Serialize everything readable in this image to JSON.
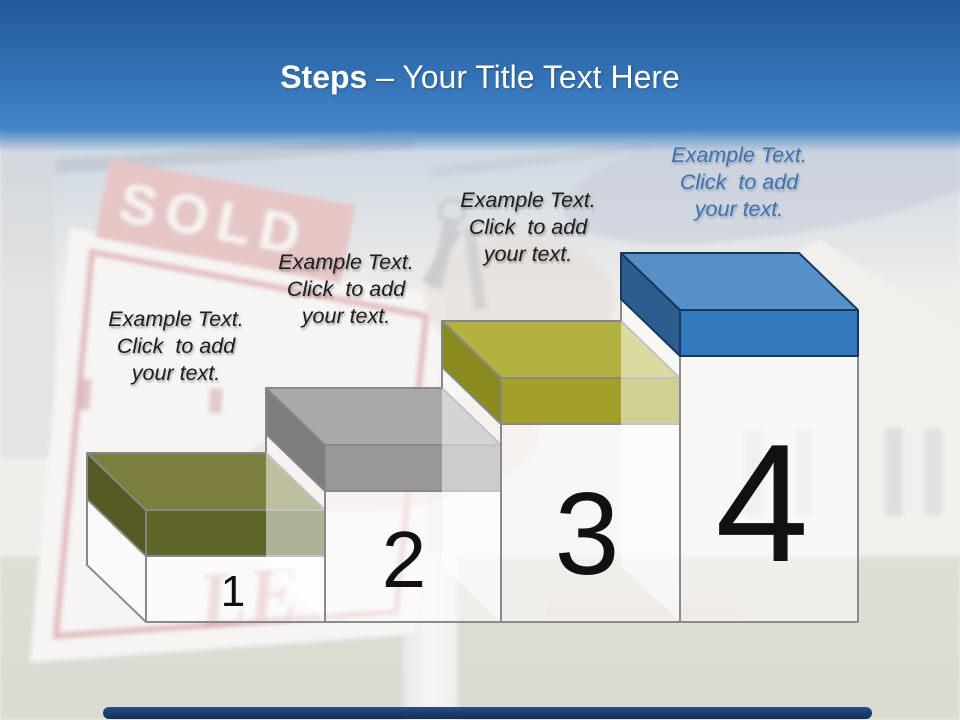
{
  "title": {
    "bold": "Steps",
    "rest": " – Your Title Text Here"
  },
  "steps": [
    {
      "number": "1",
      "label": [
        "Example Text.",
        "Click  to add",
        "your text."
      ],
      "label_color": "#1d1d1d",
      "colors": {
        "top": "#7c7f3f",
        "side": "#565a22",
        "front": "#60652a",
        "outline": "#878787"
      }
    },
    {
      "number": "2",
      "label": [
        "Example Text.",
        "Click  to add",
        "your text."
      ],
      "label_color": "#1d1d1d",
      "colors": {
        "top": "#a9a9a9",
        "side": "#7d7d7d",
        "front": "#989898",
        "outline": "#878787"
      }
    },
    {
      "number": "3",
      "label": [
        "Example Text.",
        "Click  to add",
        "your text."
      ],
      "label_color": "#1d1d1d",
      "colors": {
        "top": "#b3b240",
        "side": "#8a8a1e",
        "front": "#a3a02a",
        "outline": "#878787"
      }
    },
    {
      "number": "4",
      "label": [
        "Example Text.",
        "Click  to add",
        "your text."
      ],
      "label_color": "#3b74ae",
      "colors": {
        "top": "#5590cb",
        "side": "#2c5d8e",
        "front": "#3278bd",
        "outline": "#17375d"
      }
    }
  ],
  "photo": {
    "sold_sign_text": "SOLD",
    "sale_sign_letters": "LE"
  },
  "theme": {
    "header_gradient_top": "#24599a",
    "header_gradient_bottom": "#4685c7",
    "footer_bar": "#1d3e6c",
    "number_color": "#111111",
    "ghost_fill": "rgba(255,255,255,0.5)"
  }
}
